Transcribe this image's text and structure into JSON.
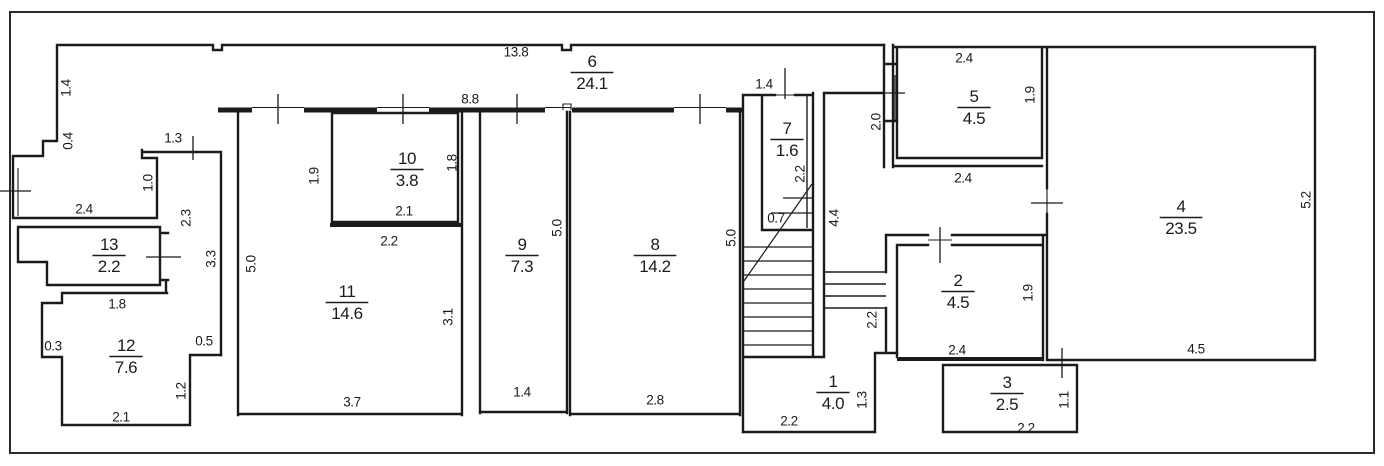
{
  "document": {
    "type": "floor-plan-drawing",
    "units_note": "",
    "colors": {
      "ink": "#1b1b1b",
      "paper": "#ffffff"
    }
  },
  "rooms": [
    {
      "number": "1",
      "area": "4.0",
      "x": 833,
      "y": 390
    },
    {
      "number": "2",
      "area": "4.5",
      "x": 958,
      "y": 289
    },
    {
      "number": "3",
      "area": "2.5",
      "x": 1007,
      "y": 391
    },
    {
      "number": "4",
      "area": "23.5",
      "x": 1181,
      "y": 215
    },
    {
      "number": "5",
      "area": "4.5",
      "x": 974,
      "y": 105
    },
    {
      "number": "6",
      "area": "24.1",
      "x": 592,
      "y": 70
    },
    {
      "number": "7",
      "area": "1.6",
      "x": 787,
      "y": 137
    },
    {
      "number": "8",
      "area": "14.2",
      "x": 655,
      "y": 253
    },
    {
      "number": "9",
      "area": "7.3",
      "x": 522,
      "y": 253
    },
    {
      "number": "10",
      "area": "3.8",
      "x": 407,
      "y": 167
    },
    {
      "number": "11",
      "area": "14.6",
      "x": 347,
      "y": 300
    },
    {
      "number": "12",
      "area": "7.6",
      "x": 126,
      "y": 354
    },
    {
      "number": "13",
      "area": "2.2",
      "x": 109,
      "y": 253
    }
  ],
  "dimensions": [
    {
      "text": "13.8",
      "x": 516,
      "y": 52,
      "vertical": false
    },
    {
      "text": "8.8",
      "x": 470,
      "y": 99,
      "vertical": false
    },
    {
      "text": "1.4",
      "x": 66,
      "y": 88,
      "vertical": true
    },
    {
      "text": "0.4",
      "x": 68,
      "y": 141,
      "vertical": true
    },
    {
      "text": "1.3",
      "x": 173,
      "y": 138,
      "vertical": false
    },
    {
      "text": "1.0",
      "x": 148,
      "y": 183,
      "vertical": true
    },
    {
      "text": "2.4",
      "x": 84,
      "y": 209,
      "vertical": false
    },
    {
      "text": "2.3",
      "x": 186,
      "y": 218,
      "vertical": true
    },
    {
      "text": "3.3",
      "x": 211,
      "y": 259,
      "vertical": true
    },
    {
      "text": "1.8",
      "x": 117,
      "y": 304,
      "vertical": false
    },
    {
      "text": "0.3",
      "x": 53,
      "y": 346,
      "vertical": false
    },
    {
      "text": "0.5",
      "x": 204,
      "y": 341,
      "vertical": false
    },
    {
      "text": "1.2",
      "x": 181,
      "y": 391,
      "vertical": true
    },
    {
      "text": "2.1",
      "x": 121,
      "y": 417,
      "vertical": false
    },
    {
      "text": "1.9",
      "x": 314,
      "y": 176,
      "vertical": true
    },
    {
      "text": "1.8",
      "x": 452,
      "y": 163,
      "vertical": true
    },
    {
      "text": "2.1",
      "x": 404,
      "y": 211,
      "vertical": false
    },
    {
      "text": "2.2",
      "x": 389,
      "y": 241,
      "vertical": false
    },
    {
      "text": "5.0",
      "x": 251,
      "y": 264,
      "vertical": true
    },
    {
      "text": "3.1",
      "x": 448,
      "y": 317,
      "vertical": true
    },
    {
      "text": "3.7",
      "x": 352,
      "y": 402,
      "vertical": false
    },
    {
      "text": "5.0",
      "x": 557,
      "y": 228,
      "vertical": true
    },
    {
      "text": "1.4",
      "x": 522,
      "y": 392,
      "vertical": false
    },
    {
      "text": "5.0",
      "x": 731,
      "y": 238,
      "vertical": true
    },
    {
      "text": "2.8",
      "x": 655,
      "y": 400,
      "vertical": false
    },
    {
      "text": "1.4",
      "x": 764,
      "y": 84,
      "vertical": false
    },
    {
      "text": "2.2",
      "x": 800,
      "y": 174,
      "vertical": true
    },
    {
      "text": "0.7",
      "x": 776,
      "y": 218,
      "vertical": false
    },
    {
      "text": "4.4",
      "x": 834,
      "y": 218,
      "vertical": true
    },
    {
      "text": "2.0",
      "x": 876,
      "y": 122,
      "vertical": true
    },
    {
      "text": "2.4",
      "x": 964,
      "y": 58,
      "vertical": false
    },
    {
      "text": "1.9",
      "x": 1030,
      "y": 95,
      "vertical": true
    },
    {
      "text": "2.4",
      "x": 963,
      "y": 178,
      "vertical": false
    },
    {
      "text": "5.2",
      "x": 1306,
      "y": 200,
      "vertical": true
    },
    {
      "text": "4.5",
      "x": 1196,
      "y": 349,
      "vertical": false
    },
    {
      "text": "1.9",
      "x": 1028,
      "y": 293,
      "vertical": true
    },
    {
      "text": "2.4",
      "x": 957,
      "y": 350,
      "vertical": false
    },
    {
      "text": "2.2",
      "x": 872,
      "y": 320,
      "vertical": true
    },
    {
      "text": "1.3",
      "x": 862,
      "y": 400,
      "vertical": true
    },
    {
      "text": "2.2",
      "x": 789,
      "y": 421,
      "vertical": false
    },
    {
      "text": "1.1",
      "x": 1064,
      "y": 400,
      "vertical": true
    },
    {
      "text": "2.2",
      "x": 1026,
      "y": 428,
      "vertical": false
    }
  ]
}
